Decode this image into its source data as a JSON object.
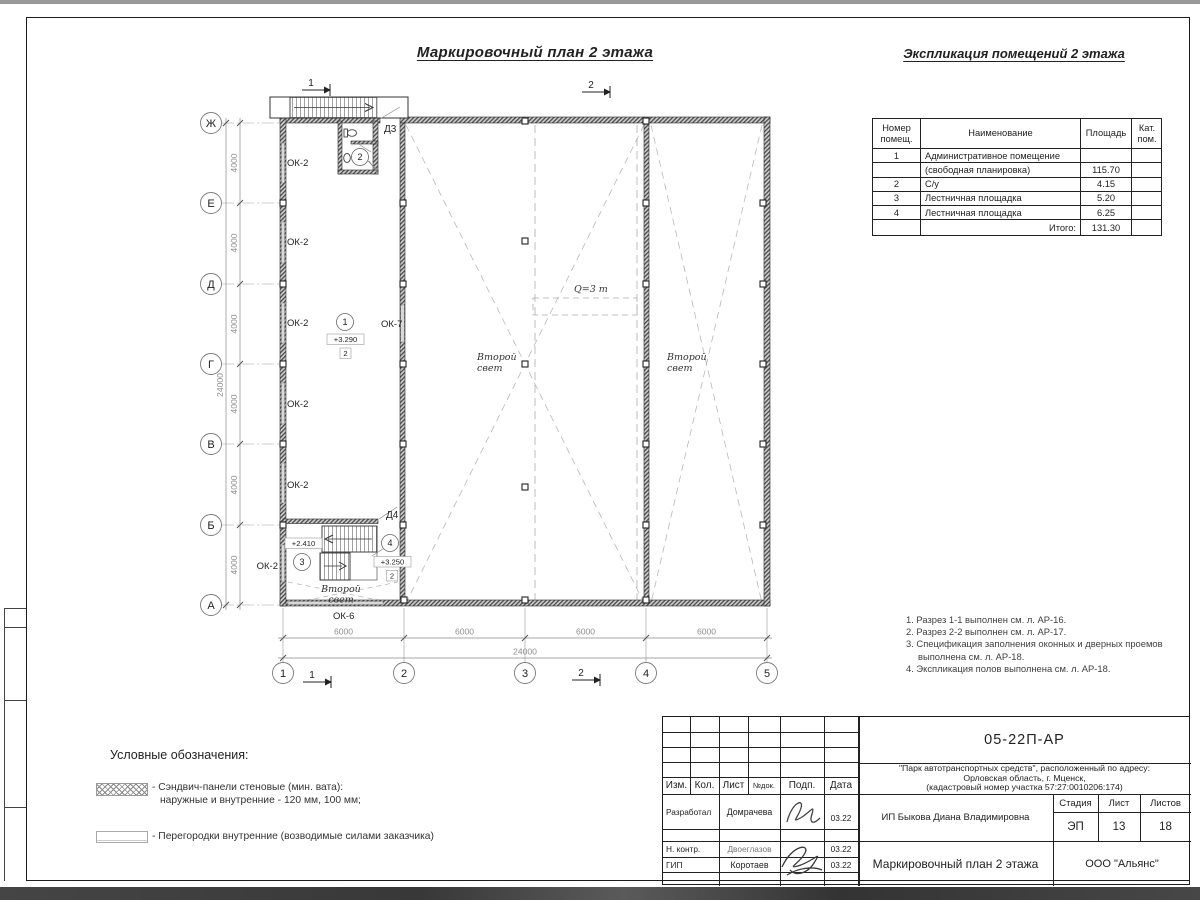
{
  "titles": {
    "plan_title": "Маркировочный план 2 этажа",
    "explication_title": "Экспликация помещений 2 этажа"
  },
  "explication": {
    "headers": {
      "num": "Номер помещ.",
      "name": "Наименование",
      "area": "Площадь",
      "cat": "Кат. пом."
    },
    "rows": [
      {
        "num": "1",
        "name": "Административное помещение",
        "area": "",
        "cat": ""
      },
      {
        "num": "",
        "name": "(свободная планировка)",
        "area": "115.70",
        "cat": ""
      },
      {
        "num": "2",
        "name": "С/у",
        "area": "4.15",
        "cat": ""
      },
      {
        "num": "3",
        "name": "Лестничная площадка",
        "area": "5.20",
        "cat": ""
      },
      {
        "num": "4",
        "name": "Лестничная площадка",
        "area": "6.25",
        "cat": ""
      }
    ],
    "total_label": "Итого:",
    "total_value": "131.30"
  },
  "notes": [
    "1. Разрез 1-1 выполнен см. л. АР-16.",
    "2. Разрез 2-2 выполнен см. л. АР-17.",
    "3. Спецификация заполнения оконных и дверных проемов выполнена см. л. АР-18.",
    "4. Экспликация полов выполнена см. л. АР-18."
  ],
  "legend": {
    "title": "Условные обозначения:",
    "item1_line1": "- Сэндвич-панели стеновые (мин. вата):",
    "item1_line2": "наружные и внутренние - 120 мм, 100 мм;",
    "item2": "- Перегородки внутренние (возводимые силами заказчика)"
  },
  "plan": {
    "row_axes": [
      "Ж",
      "Е",
      "Д",
      "Г",
      "В",
      "Б",
      "А"
    ],
    "col_axes": [
      "1",
      "2",
      "3",
      "4",
      "5"
    ],
    "dims_left": [
      "4000",
      "4000",
      "4000",
      "4000",
      "4000",
      "4000"
    ],
    "dim_left_total": "24000",
    "dims_bottom": [
      "6000",
      "6000",
      "6000",
      "6000"
    ],
    "dim_bottom_total": "24000",
    "windows": {
      "ok2": "ОК-2",
      "ok6": "ОК-6",
      "ok7": "ОК-7"
    },
    "rooms": [
      "1",
      "2",
      "3",
      "4"
    ],
    "elevations": {
      "e329": "+3.290",
      "e241": "+2.410",
      "e325": "+3.250",
      "tag": "2"
    },
    "doors": {
      "d3": "Д3",
      "d4": "Д4"
    },
    "second_light": {
      "l1": "Второй",
      "l2": "свет"
    },
    "crane": "Q=3 т",
    "sections": {
      "s1": "1",
      "s2": "2"
    }
  },
  "title_block": {
    "doc_code": "05-22П-АР",
    "project_line1": "\"Парк автотранспортных средств\",  расположенный по адресу:",
    "project_line2": "Орловская область, г. Мценск,",
    "project_line3": "(кадастровый номер участка 57:27:0010206:174)",
    "client": "ИП Быкова Диана Владимировна",
    "sheet_title": "Маркировочный план 2 этажа",
    "org": "ООО \"Альянс\"",
    "stage_label": "Стадия",
    "sheet_label": "Лист",
    "sheets_label": "Листов",
    "stage": "ЭП",
    "sheet_num": "13",
    "sheets_total": "18",
    "col_izm": "Изм.",
    "col_kol": "Кол.",
    "col_list": "Лист",
    "col_ndok": "№док.",
    "col_podp": "Подп.",
    "col_data": "Дата",
    "role_dev": "Разработал",
    "name_dev": "Домрачева",
    "date_dev": "03.22",
    "role_ncontr": "Н. контр.",
    "name_ncontr": "Двоеглазов",
    "date_ncontr": "03.22",
    "role_gip": "ГИП",
    "name_gip": "Коротаев",
    "date_gip": "03.22"
  }
}
